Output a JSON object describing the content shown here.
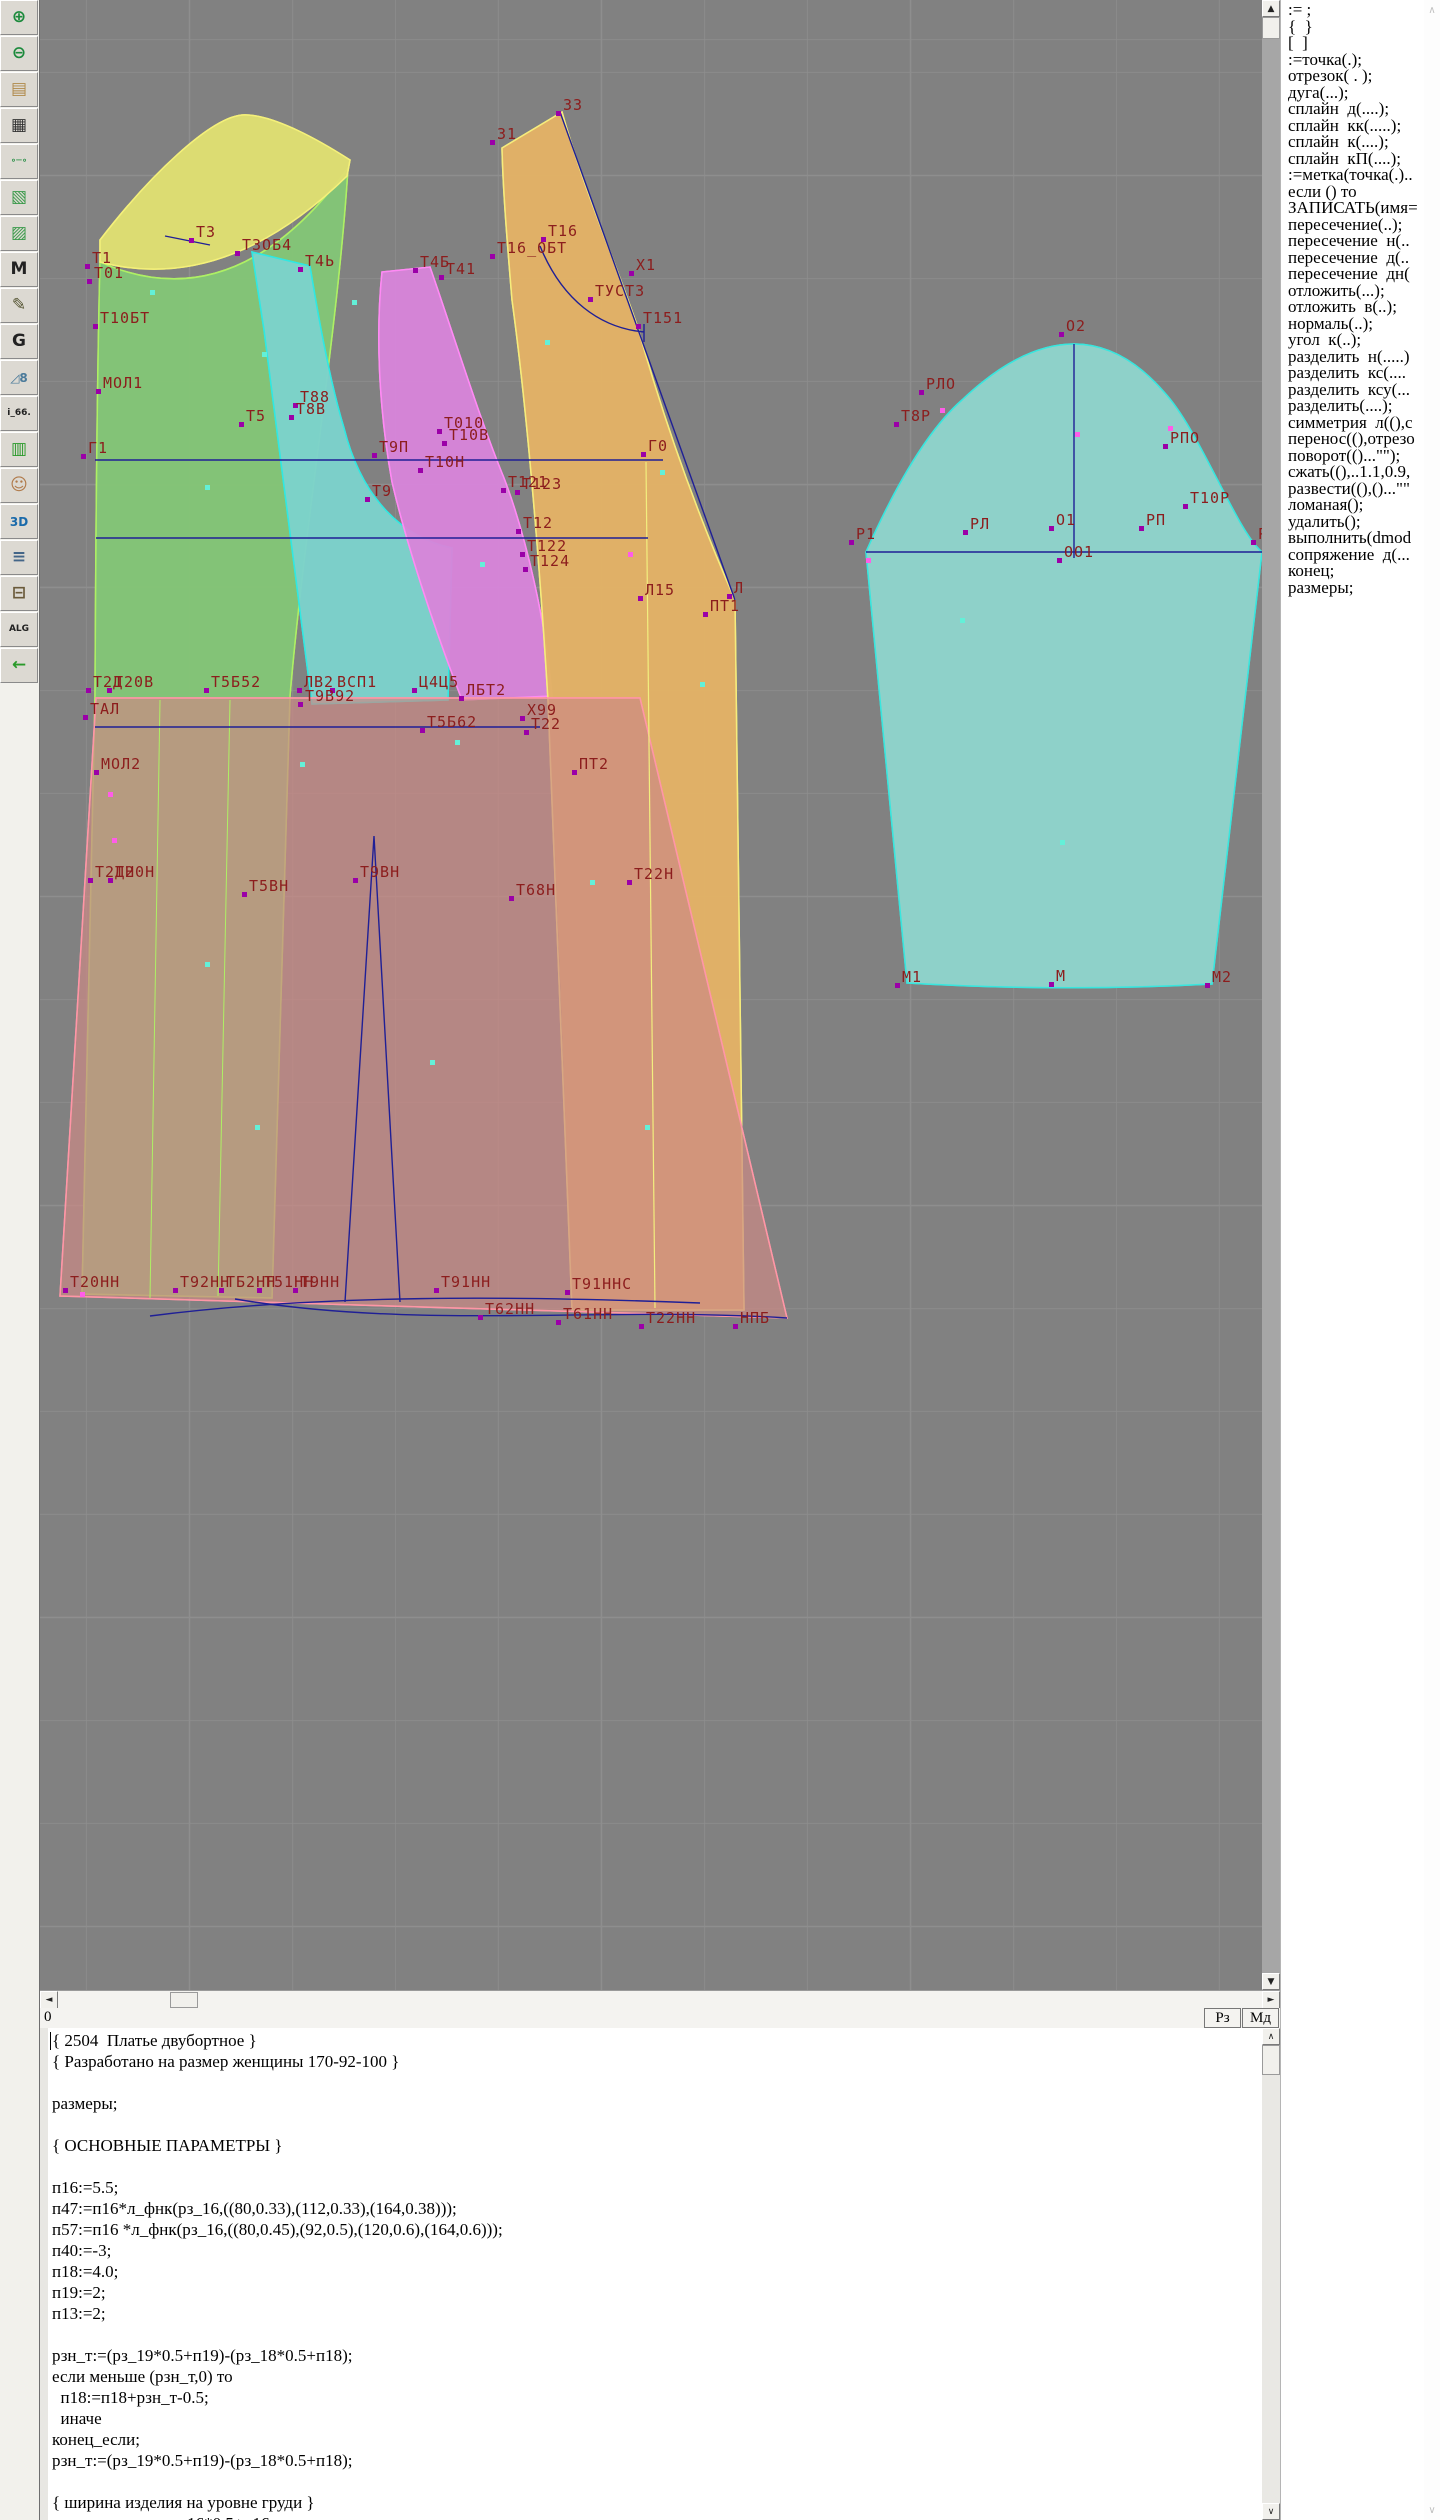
{
  "colors": {
    "canvas_bg": "#818181",
    "label_red": "#8c1d1d",
    "construction_navy": "#1f1f96",
    "marker_purple": "#9b00a8",
    "marker_pink": "#ff5ce8",
    "marker_cyan": "#63f0d8",
    "pieces": {
      "back": {
        "fill": "#83c677",
        "stroke": "#aef064"
      },
      "shoulder": {
        "fill": "#dede72",
        "stroke": "#f4f07a"
      },
      "side": {
        "fill": "#7cd2cc",
        "stroke": "#2fe8e2"
      },
      "front_detail": {
        "fill": "#d784da",
        "stroke": "#ff8af4"
      },
      "front": {
        "fill": "#e2b266",
        "stroke": "#f6ec7c"
      },
      "skirt": {
        "fill": "#cc8a84",
        "stroke": "#ff96a6"
      },
      "sleeve": {
        "fill": "#8ed2ca",
        "stroke": "#38e6de"
      }
    }
  },
  "toolbar": {
    "items": [
      {
        "name": "zoom-in",
        "glyph": "⊕",
        "color": "#1c8a3c"
      },
      {
        "name": "zoom-out",
        "glyph": "⊖",
        "color": "#1c8a3c"
      },
      {
        "name": "pattern-sheet",
        "glyph": "▤",
        "color": "#b08a4a"
      },
      {
        "name": "grid",
        "glyph": "▦",
        "color": "#333333"
      },
      {
        "name": "measure-tool",
        "glyph": "∘─∘",
        "color": "#1c8a3c"
      },
      {
        "name": "sketch-map",
        "glyph": "▧",
        "color": "#3a9a4a"
      },
      {
        "name": "pattern-outline",
        "glyph": "▨",
        "color": "#3a9a4a"
      },
      {
        "name": "pattern-m",
        "glyph": "M",
        "color": "#222222"
      },
      {
        "name": "drafting-tools",
        "glyph": "✎",
        "color": "#555533"
      },
      {
        "name": "g-document",
        "glyph": "G",
        "color": "#222222"
      },
      {
        "name": "ruler-8",
        "glyph": "◿8",
        "color": "#4a7a9a"
      },
      {
        "name": "i66-file",
        "glyph": "i_66.",
        "color": "#222222"
      },
      {
        "name": "size-table",
        "glyph": "▥",
        "color": "#2a9a2a"
      },
      {
        "name": "portrait",
        "glyph": "☺",
        "color": "#b07a4a"
      },
      {
        "name": "three-d",
        "glyph": "3D",
        "color": "#1a6aaa"
      },
      {
        "name": "text-list",
        "glyph": "≡",
        "color": "#446688"
      },
      {
        "name": "books",
        "glyph": "⊟",
        "color": "#6a5a3a"
      },
      {
        "name": "alg-file",
        "glyph": "ALG",
        "color": "#222222"
      },
      {
        "name": "exit",
        "glyph": "←",
        "color": "#2a9a2a"
      }
    ]
  },
  "canvas": {
    "labels": [
      {
        "t": "Т3",
        "x": 196,
        "y": 237
      },
      {
        "t": "Т1",
        "x": 92,
        "y": 263
      },
      {
        "t": "Т01",
        "x": 94,
        "y": 278
      },
      {
        "t": "Т3ОБ4",
        "x": 242,
        "y": 250
      },
      {
        "t": "Т4Ь",
        "x": 305,
        "y": 266
      },
      {
        "t": "Т10БТ",
        "x": 100,
        "y": 323
      },
      {
        "t": "МОЛ1",
        "x": 103,
        "y": 388
      },
      {
        "t": "Т5",
        "x": 246,
        "y": 421
      },
      {
        "t": "Т88",
        "x": 300,
        "y": 402
      },
      {
        "t": "Т8В",
        "x": 296,
        "y": 414
      },
      {
        "t": "Г1",
        "x": 88,
        "y": 453
      },
      {
        "t": "Т9П",
        "x": 379,
        "y": 452
      },
      {
        "t": "Т010",
        "x": 444,
        "y": 428
      },
      {
        "t": "Т10В",
        "x": 449,
        "y": 440
      },
      {
        "t": "Т10Н",
        "x": 425,
        "y": 467
      },
      {
        "t": "Т9",
        "x": 372,
        "y": 496
      },
      {
        "t": "Т121",
        "x": 508,
        "y": 487
      },
      {
        "t": "Т123",
        "x": 522,
        "y": 489
      },
      {
        "t": "Т12",
        "x": 523,
        "y": 528
      },
      {
        "t": "Т122",
        "x": 527,
        "y": 551
      },
      {
        "t": "Т124",
        "x": 530,
        "y": 566
      },
      {
        "t": "Т4Б",
        "x": 420,
        "y": 267
      },
      {
        "t": "Т41",
        "x": 446,
        "y": 274
      },
      {
        "t": "33",
        "x": 563,
        "y": 110
      },
      {
        "t": "31",
        "x": 497,
        "y": 139
      },
      {
        "t": "Т16",
        "x": 548,
        "y": 236
      },
      {
        "t": "Т16_ОБТ",
        "x": 497,
        "y": 253
      },
      {
        "t": "Х1",
        "x": 636,
        "y": 270
      },
      {
        "t": "ТУСТ3",
        "x": 595,
        "y": 296
      },
      {
        "t": "Т151",
        "x": 643,
        "y": 323
      },
      {
        "t": "Г0",
        "x": 648,
        "y": 451
      },
      {
        "t": "Л15",
        "x": 645,
        "y": 595
      },
      {
        "t": "Л",
        "x": 734,
        "y": 593
      },
      {
        "t": "ПТ1",
        "x": 710,
        "y": 611
      },
      {
        "t": "Т2Д",
        "x": 93,
        "y": 687
      },
      {
        "t": "Т20В",
        "x": 114,
        "y": 687
      },
      {
        "t": "Т5Б52",
        "x": 211,
        "y": 687
      },
      {
        "t": "ЛВ2",
        "x": 304,
        "y": 687
      },
      {
        "t": "ВСП1",
        "x": 337,
        "y": 687
      },
      {
        "t": "Ц4Ц5",
        "x": 419,
        "y": 687
      },
      {
        "t": "ЛБТ2",
        "x": 466,
        "y": 695
      },
      {
        "t": "Т9В92",
        "x": 305,
        "y": 701
      },
      {
        "t": "ТАЛ",
        "x": 90,
        "y": 714
      },
      {
        "t": "Т5Б62",
        "x": 427,
        "y": 727
      },
      {
        "t": "Х99",
        "x": 527,
        "y": 715
      },
      {
        "t": "Т22",
        "x": 531,
        "y": 729
      },
      {
        "t": "МОЛ2",
        "x": 101,
        "y": 769
      },
      {
        "t": "ПТ2",
        "x": 579,
        "y": 769
      },
      {
        "t": "Т2ДН",
        "x": 95,
        "y": 877
      },
      {
        "t": "Т20Н",
        "x": 115,
        "y": 877
      },
      {
        "t": "Т5ВН",
        "x": 249,
        "y": 891
      },
      {
        "t": "Т9ВН",
        "x": 360,
        "y": 877
      },
      {
        "t": "Т68Н",
        "x": 516,
        "y": 895
      },
      {
        "t": "Т22Н",
        "x": 634,
        "y": 879
      },
      {
        "t": "Т20НН",
        "x": 70,
        "y": 1287
      },
      {
        "t": "Т92НН",
        "x": 180,
        "y": 1287
      },
      {
        "t": "ТБ2НН",
        "x": 226,
        "y": 1287
      },
      {
        "t": "Т51НН",
        "x": 264,
        "y": 1287
      },
      {
        "t": "Т9НН",
        "x": 300,
        "y": 1287
      },
      {
        "t": "Т91НН",
        "x": 441,
        "y": 1287
      },
      {
        "t": "Т91ННС",
        "x": 572,
        "y": 1289
      },
      {
        "t": "Т62НН",
        "x": 485,
        "y": 1314
      },
      {
        "t": "Т61НН",
        "x": 563,
        "y": 1319
      },
      {
        "t": "Т22НН",
        "x": 646,
        "y": 1323
      },
      {
        "t": "НПБ",
        "x": 740,
        "y": 1323
      },
      {
        "t": "О2",
        "x": 1066,
        "y": 331
      },
      {
        "t": "РЛО",
        "x": 926,
        "y": 389
      },
      {
        "t": "Т8Р",
        "x": 901,
        "y": 421
      },
      {
        "t": "РПО",
        "x": 1170,
        "y": 443
      },
      {
        "t": "Р1",
        "x": 856,
        "y": 539
      },
      {
        "t": "РЛ",
        "x": 970,
        "y": 529
      },
      {
        "t": "О1",
        "x": 1056,
        "y": 525
      },
      {
        "t": "ОО1",
        "x": 1064,
        "y": 557
      },
      {
        "t": "РП",
        "x": 1146,
        "y": 525
      },
      {
        "t": "Т10Р",
        "x": 1190,
        "y": 503
      },
      {
        "t": "Р",
        "x": 1258,
        "y": 539
      },
      {
        "t": "М1",
        "x": 902,
        "y": 982
      },
      {
        "t": "М",
        "x": 1056,
        "y": 981
      },
      {
        "t": "М2",
        "x": 1212,
        "y": 982
      }
    ],
    "accent_markers": [
      {
        "x": 150,
        "y": 290,
        "c": "#63f0d8"
      },
      {
        "x": 262,
        "y": 352,
        "c": "#63f0d8"
      },
      {
        "x": 205,
        "y": 485,
        "c": "#63f0d8"
      },
      {
        "x": 352,
        "y": 300,
        "c": "#63f0d8"
      },
      {
        "x": 300,
        "y": 762,
        "c": "#63f0d8"
      },
      {
        "x": 205,
        "y": 962,
        "c": "#63f0d8"
      },
      {
        "x": 360,
        "y": 680,
        "c": "#63f0d8"
      },
      {
        "x": 480,
        "y": 562,
        "c": "#63f0d8"
      },
      {
        "x": 660,
        "y": 470,
        "c": "#63f0d8"
      },
      {
        "x": 700,
        "y": 682,
        "c": "#63f0d8"
      },
      {
        "x": 590,
        "y": 880,
        "c": "#63f0d8"
      },
      {
        "x": 430,
        "y": 1060,
        "c": "#63f0d8"
      },
      {
        "x": 255,
        "y": 1125,
        "c": "#63f0d8"
      },
      {
        "x": 645,
        "y": 1125,
        "c": "#63f0d8"
      },
      {
        "x": 960,
        "y": 618,
        "c": "#63f0d8"
      },
      {
        "x": 1060,
        "y": 840,
        "c": "#63f0d8"
      },
      {
        "x": 455,
        "y": 740,
        "c": "#63f0d8"
      },
      {
        "x": 545,
        "y": 340,
        "c": "#63f0d8"
      },
      {
        "x": 108,
        "y": 792,
        "c": "#ff5ce8"
      },
      {
        "x": 112,
        "y": 838,
        "c": "#ff5ce8"
      },
      {
        "x": 940,
        "y": 408,
        "c": "#ff5ce8"
      },
      {
        "x": 1168,
        "y": 426,
        "c": "#ff5ce8"
      },
      {
        "x": 1075,
        "y": 432,
        "c": "#ff5ce8"
      },
      {
        "x": 628,
        "y": 552,
        "c": "#ff5ce8"
      },
      {
        "x": 866,
        "y": 558,
        "c": "#ff5ce8"
      },
      {
        "x": 80,
        "y": 1292,
        "c": "#ff5ce8"
      }
    ]
  },
  "hscrollbar": {
    "left_arrow": "◄",
    "right_arrow": "►"
  },
  "vscrollbar": {
    "up_arrow": "▲",
    "down_arrow": "▼"
  },
  "editor_scrollbar": {
    "up_arrow": "∧",
    "down_arrow": "∨"
  },
  "status": {
    "left_value": "0",
    "buttons": [
      "Рз",
      "Мд"
    ]
  },
  "commands": {
    "items": [
      ":= ;",
      "{  }",
      "[  ]",
      ":=точка(.);",
      "отрезок( . );",
      "дуга(...);",
      "сплайн  д(....);",
      "сплайн  кк(.....);",
      "сплайн  к(....);",
      "сплайн  кП(....);",
      ":=метка(точка(.)..",
      "если () то",
      "ЗАПИСАТЬ(имя=",
      "пересечение(..);",
      "пересечение  н(..",
      "пересечение  д(..",
      "пересечение  дн(",
      "отложить(...);",
      "отложить  в(..);",
      "нормаль(..);",
      "угол  к(..);",
      "разделить  н(.....)",
      "разделить  кс(....",
      "разделить  ксу(...",
      "разделить(....);",
      "симметрия  л((),с",
      "перенос((),отрезо",
      "поворот(()...\"\");",
      "сжать((),..1.1,0.9,",
      "развести((),()...\"\"",
      "ломаная();",
      "удалить();",
      "выполнить(dmod",
      "сопряжение  д(...",
      "конец;",
      "размеры;"
    ]
  },
  "script": {
    "lines": [
      "{ 2504  Платье двубортное }",
      "{ Разработано на размер женщины 170-92-100 }",
      "",
      "размеры;",
      "",
      "{ ОСНОВНЫЕ ПАРАМЕТРЫ }",
      "",
      "п16:=5.5;",
      "п47:=п16*л_фнк(рз_16,((80,0.33),(112,0.33),(164,0.38)));",
      "п57:=п16 *л_фнк(рз_16,((80,0.45),(92,0.5),(120,0.6),(164,0.6)));",
      "п40:=-3;",
      "п18:=4.0;",
      "п19:=2;",
      "п13:=2;",
      "",
      "рзн_т:=(рз_19*0.5+п19)-(рз_18*0.5+п18);",
      "если меньше (рзн_т,0) то",
      "  п18:=п18+рзн_т-0.5;",
      "  иначе",
      "конец_если;",
      "рзн_т:=(рз_19*0.5+п19)-(рз_18*0.5+п18);",
      "",
      "{ ширина изделия на уровне груди }",
      "    шир_изд_в:=рз_16*0.5+п16 ;"
    ]
  }
}
